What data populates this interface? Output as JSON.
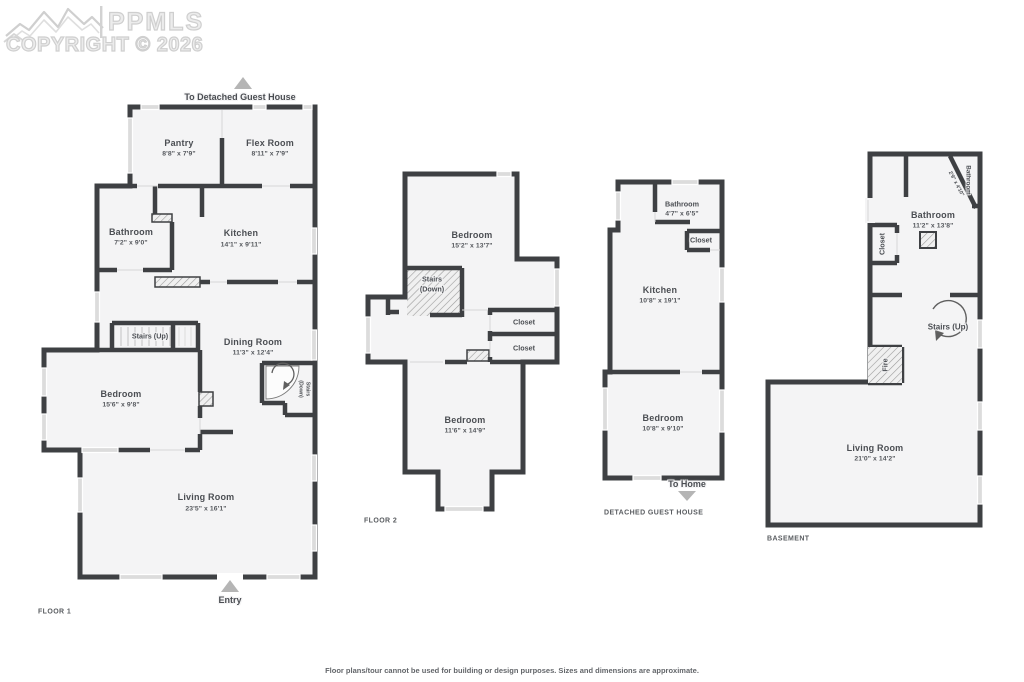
{
  "watermark": {
    "brand": "PPMLS",
    "copyright": "COPYRIGHT © 2026"
  },
  "footer": {
    "disclaimer": "Floor plans/tour cannot be used for building or design purposes. Sizes and dimensions are approximate."
  },
  "floor1": {
    "label": "FLOOR 1",
    "to_guest_house": "To Detached Guest House",
    "entry": "Entry",
    "pantry": {
      "name": "Pantry",
      "dims": "8'8\" x 7'9\""
    },
    "flex_room": {
      "name": "Flex Room",
      "dims": "8'11\" x 7'9\""
    },
    "bathroom": {
      "name": "Bathroom",
      "dims": "7'2\" x 9'0\""
    },
    "kitchen": {
      "name": "Kitchen",
      "dims": "14'1\" x 9'11\""
    },
    "stairs_up": {
      "name": "Stairs (Up)"
    },
    "dining_room": {
      "name": "Dining Room",
      "dims": "11'3\" x 12'4\""
    },
    "stairs_down": {
      "line1": "Stairs",
      "line2": "(Down)"
    },
    "bedroom": {
      "name": "Bedroom",
      "dims": "15'6\" x 9'8\""
    },
    "living_room": {
      "name": "Living Room",
      "dims": "23'5\" x 16'1\""
    }
  },
  "floor2": {
    "label": "FLOOR 2",
    "bedroom1": {
      "name": "Bedroom",
      "dims": "15'2\" x 13'7\""
    },
    "stairs_down": {
      "line1": "Stairs",
      "line2": "(Down)"
    },
    "closet1": {
      "name": "Closet"
    },
    "closet2": {
      "name": "Closet"
    },
    "bedroom2": {
      "name": "Bedroom",
      "dims": "11'6\" x 14'9\""
    }
  },
  "guest_house": {
    "label": "DETACHED GUEST HOUSE",
    "to_home": "To Home",
    "bathroom": {
      "name": "Bathroom",
      "dims": "4'7\" x 6'5\""
    },
    "closet": {
      "name": "Closet"
    },
    "kitchen": {
      "name": "Kitchen",
      "dims": "10'8\" x 19'1\""
    },
    "bedroom": {
      "name": "Bedroom",
      "dims": "10'8\" x 9'10\""
    }
  },
  "basement": {
    "label": "BASEMENT",
    "bathroom_small": {
      "name": "Bathroom",
      "dims": "2'9\" x 4'10\""
    },
    "bathroom": {
      "name": "Bathroom",
      "dims": "11'2\" x 13'8\""
    },
    "closet": {
      "name": "Closet"
    },
    "stairs_up": {
      "name": "Stairs (Up)"
    },
    "fire": {
      "name": "Fire"
    },
    "living_room": {
      "name": "Living Room",
      "dims": "21'0\" x 14'2\""
    }
  },
  "colors": {
    "wall": "#3e4043",
    "room_fill": "#f4f4f5",
    "window": "#dcdcdc",
    "label_text": "#4b4e53",
    "arrow": "#b5b5b5",
    "watermark": "#cfcfcf"
  }
}
